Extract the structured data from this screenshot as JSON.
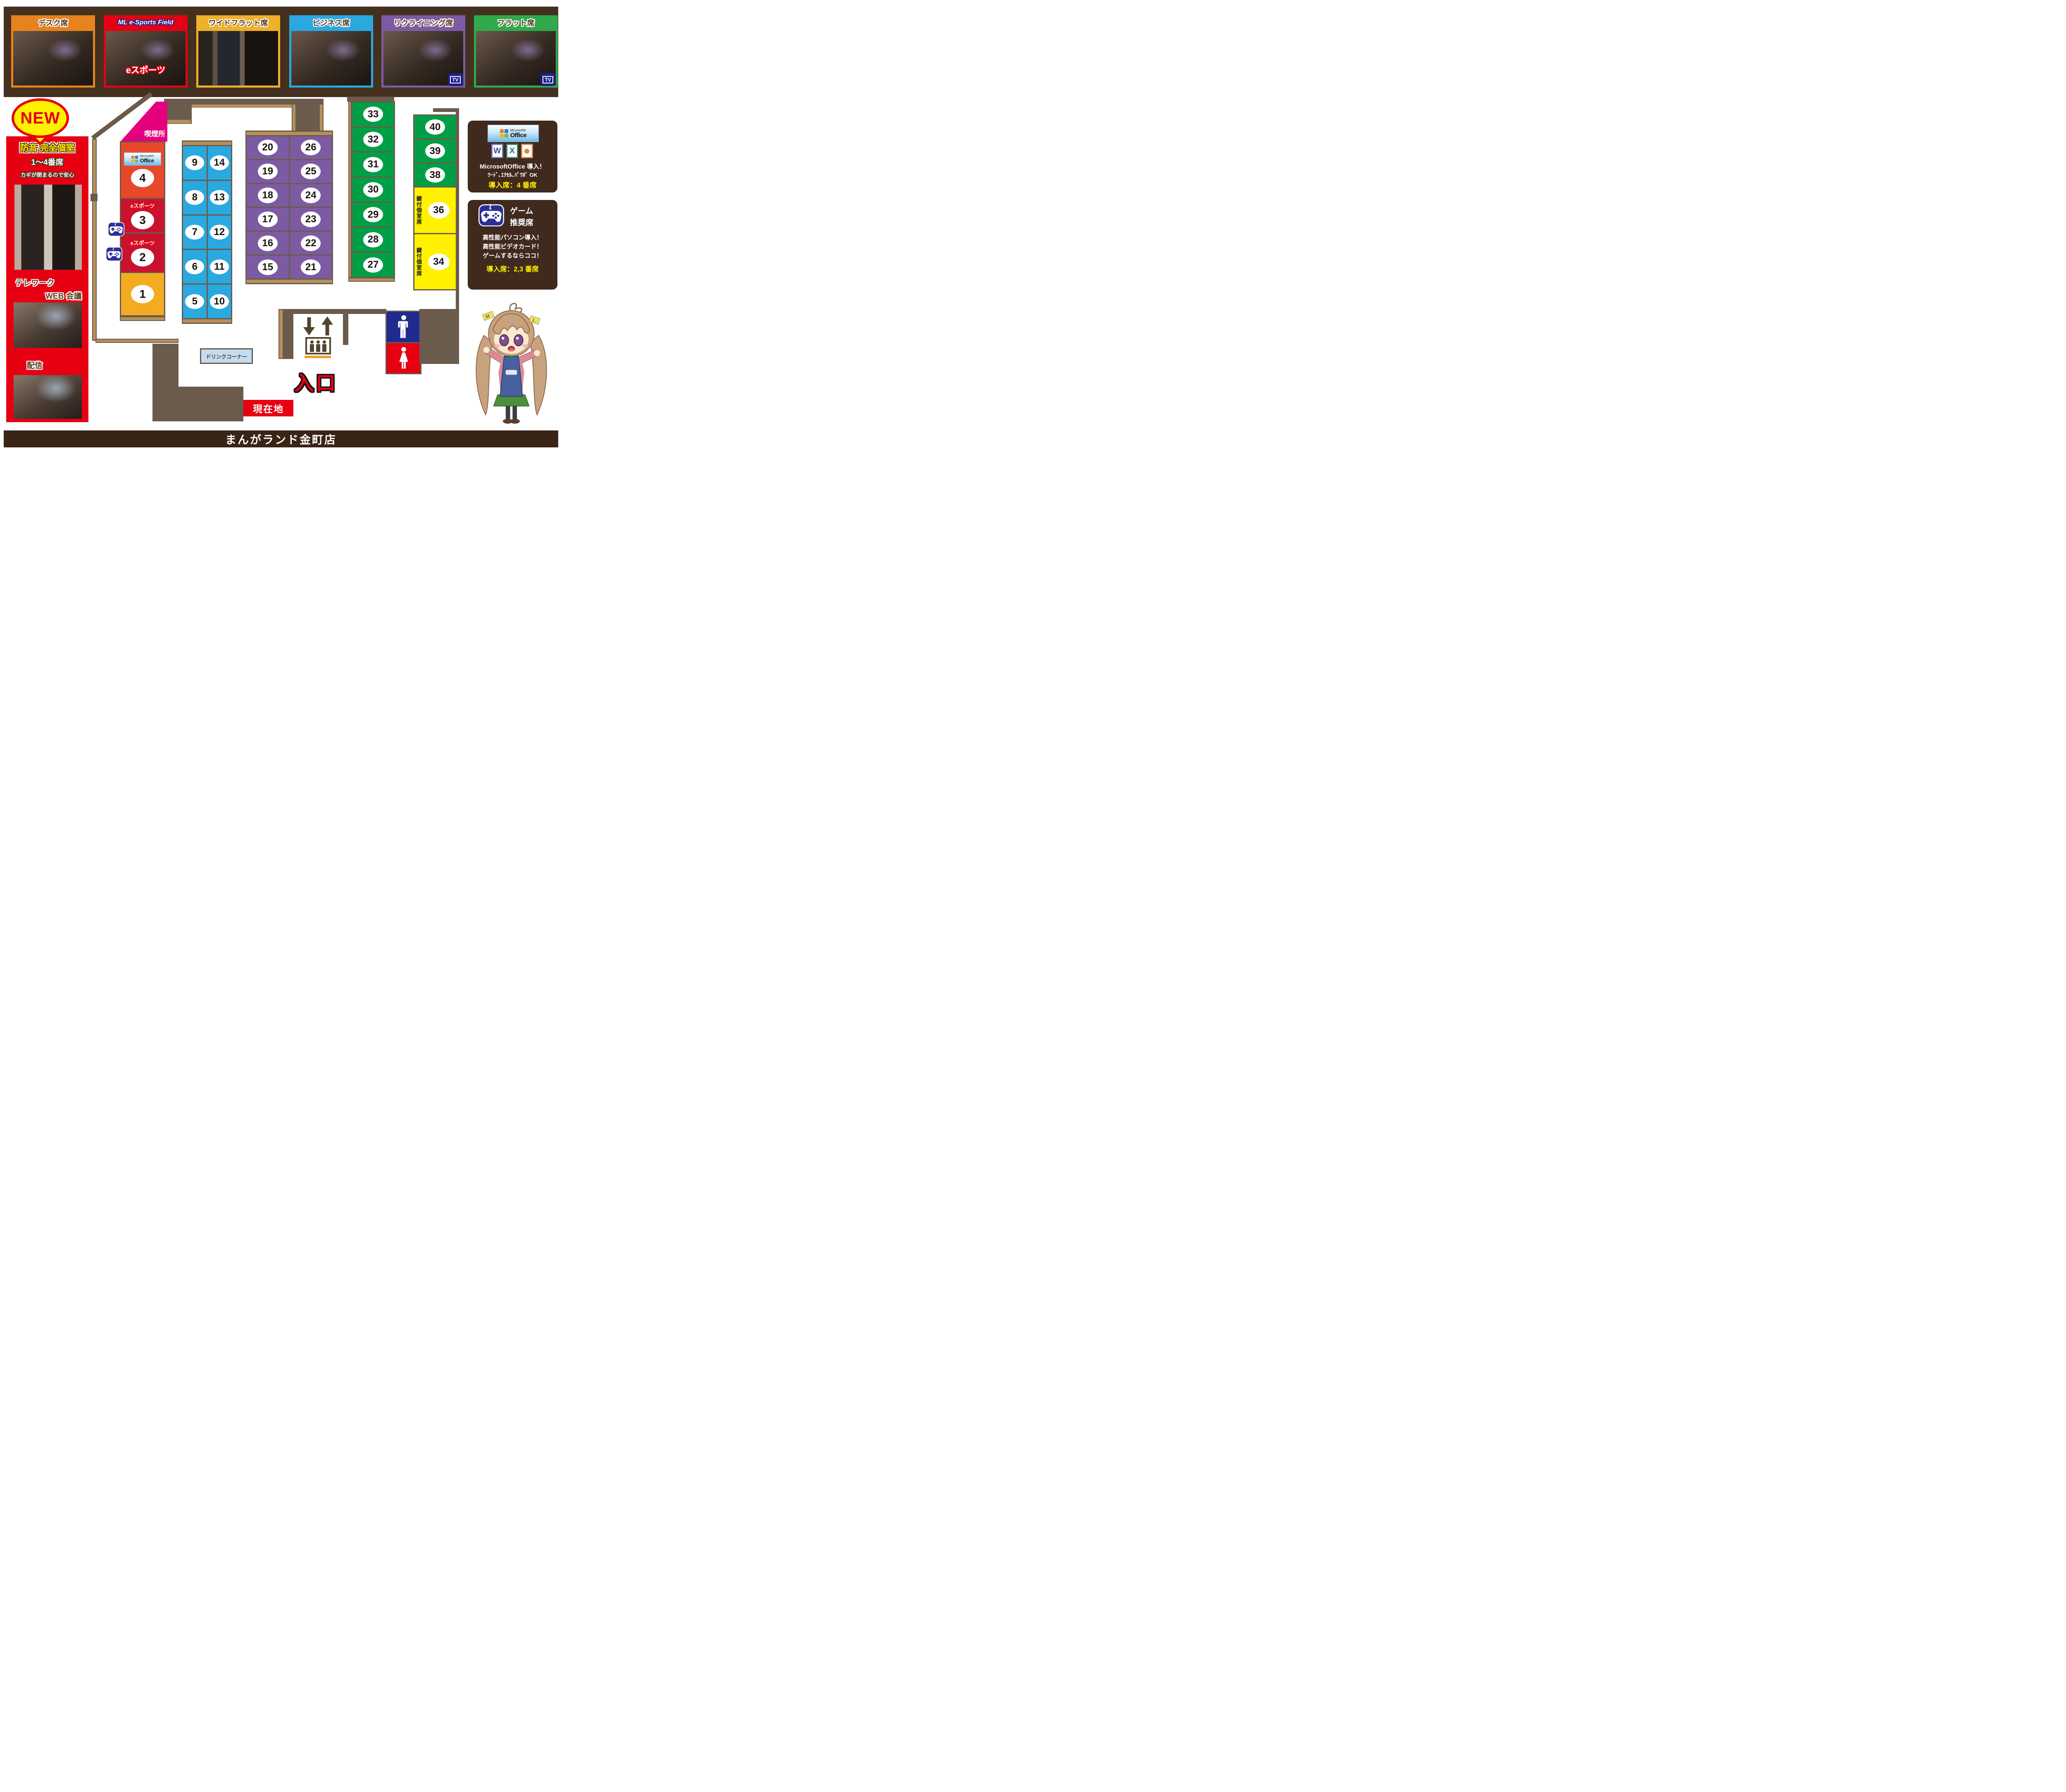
{
  "colors": {
    "strip": "#44301f",
    "wall_dark": "#6a5b4d",
    "wall_tan": "#b6905a",
    "pink": "#e5007e",
    "red": "#e60012",
    "yellow": "#fff100",
    "amber": "#f3ac22",
    "crimson": "#c9132e",
    "orange_red": "#e8482a",
    "blue_seat": "#29a9e0",
    "purple_seat": "#7c5ba3",
    "green_seat": "#009f45",
    "navy": "#1d2088",
    "panel_brown": "#40291d"
  },
  "top_panels": [
    {
      "label": "デスク席",
      "color": "#e8821c",
      "style": "plain",
      "tv": false,
      "overlay": ""
    },
    {
      "label": "ML e-Sports Field",
      "color": "#e60012",
      "style": "esports",
      "tv": false,
      "overlay": "eスポーツ"
    },
    {
      "label": "ワイドフラット席",
      "color": "#efb02a",
      "style": "plain",
      "tv": false,
      "overlay": "",
      "photo": "corr"
    },
    {
      "label": "ビジネス席",
      "color": "#29a9e0",
      "style": "plain",
      "tv": false,
      "overlay": ""
    },
    {
      "label": "リクライニング席",
      "color": "#7c5ba3",
      "style": "plain",
      "tv": true,
      "overlay": ""
    },
    {
      "label": "フラット席",
      "color": "#2fa94c",
      "style": "plain",
      "tv": true,
      "overlay": ""
    }
  ],
  "tv_label": "TV",
  "left_column": {
    "new_badge": "NEW",
    "title": "防音 完全個室",
    "subtitle": "1～4番席",
    "note": "カギが閉まるので安心",
    "caption_telework": "テレワーク",
    "caption_web": "WEB 会議",
    "caption_stream": "配信"
  },
  "map": {
    "smoking": "喫煙所",
    "esports_label": "eスポーツ",
    "keyed_label": "鍵付個室席",
    "drink": "ドリンクコーナー",
    "entrance": "入口",
    "here": "現在地",
    "office_logo": {
      "brand": "Microsoft®",
      "product": "Office"
    },
    "private_seats": [
      {
        "num": "4",
        "color": "#e8482a",
        "logo": true,
        "label": ""
      },
      {
        "num": "3",
        "color": "#c9132e",
        "logo": false,
        "label": "eスポーツ"
      },
      {
        "num": "2",
        "color": "#c9132e",
        "logo": false,
        "label": "eスポーツ"
      },
      {
        "num": "1",
        "color": "#f3ac22",
        "logo": false,
        "label": ""
      }
    ],
    "blue_left": [
      "9",
      "8",
      "7",
      "6",
      "5"
    ],
    "blue_right": [
      "14",
      "13",
      "12",
      "11",
      "10"
    ],
    "purple_left": [
      "20",
      "19",
      "18",
      "17",
      "16",
      "15"
    ],
    "purple_right": [
      "26",
      "25",
      "24",
      "23",
      "22",
      "21"
    ],
    "green_col": [
      "33",
      "32",
      "31",
      "30",
      "29",
      "28",
      "27"
    ],
    "green_right": [
      "40",
      "39",
      "38"
    ],
    "yellow_cells": [
      {
        "num": "36",
        "label": "鍵付個室席"
      },
      {
        "num": "34",
        "label": "鍵付個室席"
      }
    ]
  },
  "office_panel": {
    "logo_brand": "Microsoft®",
    "logo_product": "Office",
    "icon_word": "W",
    "icon_excel": "X",
    "line1": "MicrosoftOffice 導入！",
    "line2": "ﾜｰﾄﾞ､ｴｸｾﾙ､ﾊﾟﾜﾎﾟ OK",
    "line3": "導入席：4 番席"
  },
  "game_panel": {
    "title1": "ゲーム",
    "title2": "推奨席",
    "line1": "高性能パソコン導入！",
    "line2": "高性能ビデオカード！",
    "line3": "ゲームするならココ！",
    "line4": "導入席：2,3 番席"
  },
  "footer": {
    "title": "まんがランド金町店"
  }
}
